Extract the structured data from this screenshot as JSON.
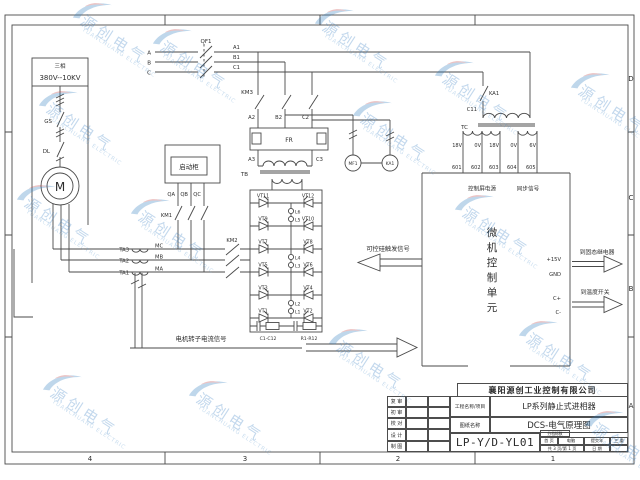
{
  "frame": {
    "letters": [
      "D",
      "C",
      "B",
      "A"
    ],
    "numbers": [
      "4",
      "3",
      "2",
      "1"
    ]
  },
  "supply": {
    "phase": "三相",
    "voltage": "380V--10KV",
    "gs": "GS",
    "dl": "DL",
    "motor": "M"
  },
  "top": {
    "qf1": "QF1",
    "a": "A",
    "b": "B",
    "c": "C",
    "a1": "A1",
    "b1": "B1",
    "c1": "C1",
    "km3": "KM3",
    "a2": "A2",
    "b2": "B2",
    "c2": "C2",
    "fr": "FR",
    "a3": "A3",
    "c3": "C3",
    "tb": "TB"
  },
  "cabinet": {
    "label": "启动柜",
    "qa": "QA",
    "qb": "QB",
    "qc": "QC",
    "km1": "KM1",
    "km2": "KM2"
  },
  "ct": {
    "ta3": "TA3",
    "ta2": "TA2",
    "ta1": "TA1",
    "mc": "MC",
    "mb": "MB",
    "ma": "MA"
  },
  "bridge": {
    "vt1": "VT1",
    "vt2": "VT2",
    "vt3": "VT3",
    "vt4": "VT4",
    "vt5": "VT5",
    "vt6": "VT6",
    "vt7": "VT7",
    "vt8": "VT8",
    "vt9": "VT9",
    "vt10": "VT10",
    "vt11": "VT11",
    "vt12": "VT12",
    "l1": "L1",
    "l2": "L2",
    "l3": "L3",
    "l4": "L4",
    "l5": "L5",
    "l6": "L6",
    "c_label": "C1-C12",
    "r_label": "R1-R12"
  },
  "fan": {
    "mf1": "MF1",
    "ka1": "KA1"
  },
  "tc": {
    "ka1": "KA1",
    "c11": "C11",
    "label": "TC",
    "v": [
      "18V",
      "0V",
      "18V",
      "0V",
      "6V"
    ],
    "t": [
      "601",
      "602",
      "603",
      "604",
      "605"
    ],
    "power": "控制屏电源",
    "sync": "同步信号"
  },
  "mcu": {
    "chars": [
      "微",
      "机",
      "控",
      "制",
      "单",
      "元"
    ],
    "p15": "+15V",
    "gnd": "GND",
    "cplus": "C+",
    "cminus": "C-"
  },
  "signals": {
    "trigger": "可控硅触发信号",
    "rotor": "电机转子电流信号",
    "to_relay": "到固态继电器",
    "to_temp": "到温度开关"
  },
  "titleblock": {
    "company": "襄阳源创工业控制有限公司",
    "review_rows": [
      "复 审",
      "初 审",
      "校 对",
      "设 计",
      "制 图"
    ],
    "project_label": "工程名称/项目",
    "project_value": "LP系列静止式进相器",
    "drawing_label": "图纸名称",
    "drawing_value": "DCS-电气原理图",
    "code": "LP-Y/D-YL01",
    "mini": {
      "head": "分档标数",
      "r1c1": "首 页",
      "r1c2": "电脑",
      "r1c3": "提交年",
      "r1c4": "三 重",
      "r2c1": "共 3 页/第 1 页",
      "r2c2": "日 期"
    }
  },
  "watermark": {
    "cn": "源创电气",
    "en": "YUANCHUANG ELECTRIC"
  }
}
